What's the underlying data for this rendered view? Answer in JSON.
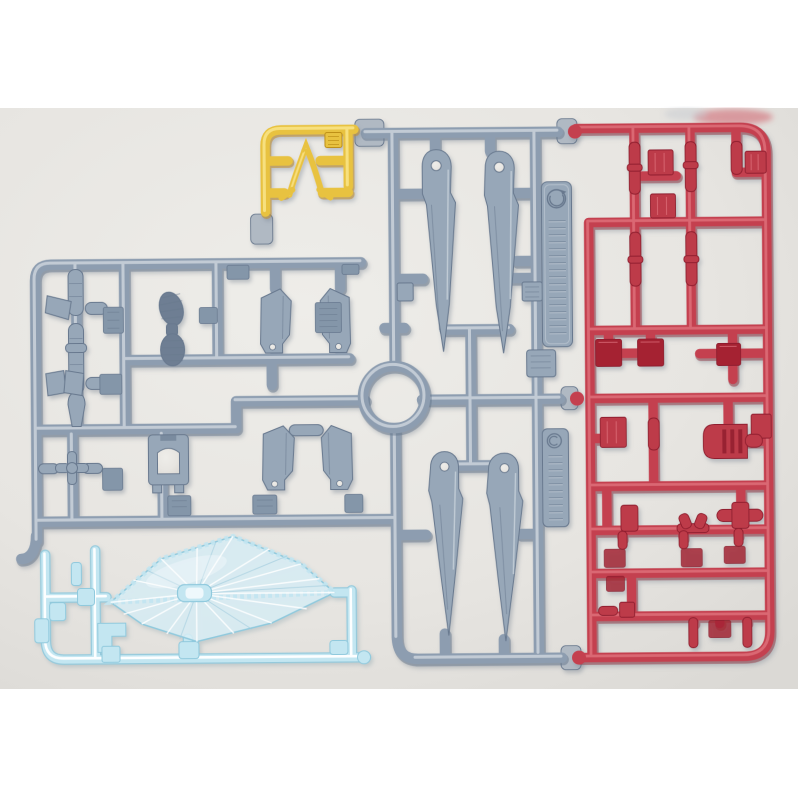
{
  "meta": {
    "description": "Product photograph of plastic model-kit part runners (sprues) laid on a pale studio backdrop",
    "image_width": 798,
    "image_height": 798
  },
  "photo": {
    "page_color": "#ffffff",
    "backdrop_center_color": "#edecе9",
    "backdrop_center": "#edece9",
    "backdrop_edge": "#dcdad6",
    "top_band_height_px": 108,
    "photo_bottom_edge_px": 689,
    "defocused_red_smudge_color": "#d0616c"
  },
  "palette": {
    "page": "#ffffff",
    "backdrop": "#e9e7e4",
    "backdrop_edge": "#dcdad6",
    "gray": "#8d9db0",
    "gray_hi": "#cbd4dc",
    "gray_dk": "#5f7087",
    "gray_part": "#97a7b8",
    "gray_part_dark": "#67788e",
    "gray_sole": "#6e7e93",
    "gray_pad": "#8496a9",
    "nub": "#b0b9c3",
    "yellow": "#e8c23f",
    "yellow_hi": "#f8e182",
    "yellow_dk": "#bd8f17",
    "red": "#c4414f",
    "red_hi": "#e0717c",
    "red_dk": "#8f1f2e",
    "red_part": "#bd3a49",
    "red_dark_part": "#a52433",
    "blue": "#c3e6f1",
    "blue_hi": "#ffffff",
    "blue_edge": "#8fc9dd",
    "blue_fill": "#d9eef6",
    "smudge": "#d0616c",
    "shadow": "#70798a"
  },
  "runners": [
    {
      "id": "gray-main-runner",
      "plastic": "gray",
      "primary_color": "#8d9db0",
      "parts": [
        "leg-blade-part x4",
        "side-armor-part x4",
        "foot-sole-part x2",
        "bracket-part",
        "joint-spindle-part x5",
        "flap-part x3",
        "claw-joint-part",
        "gate-pad x10",
        "ring-runner",
        "molded-tag x2",
        "detail-plate x3"
      ]
    },
    {
      "id": "yellow-runner",
      "plastic": "yellow",
      "primary_color": "#e8c23f",
      "parts": [
        "v-fin-antenna-part",
        "flat-tab-part"
      ]
    },
    {
      "id": "red-runner",
      "plastic": "red",
      "primary_color": "#c4414f",
      "parts": [
        "thruster-box-part x5",
        "dark-plate-part x3",
        "vented-dome-part",
        "joint-spindle-part x9",
        "gate-pad x8",
        "cross-joint-part",
        "y-joint-part"
      ]
    },
    {
      "id": "clear-blue-runner",
      "plastic": "clear blue",
      "primary_color": "#c3e6f1",
      "parts": [
        "burst-effect-diamond-part",
        "peg-connector-part",
        "l-bracket-part",
        "clip-part x5"
      ]
    }
  ],
  "tags": [
    {
      "id": "molded-tag-upper",
      "icon": "recycle-circle-icon",
      "legible": false
    },
    {
      "id": "molded-tag-lower",
      "icon": "copyright-circle-icon",
      "legible": false
    }
  ]
}
